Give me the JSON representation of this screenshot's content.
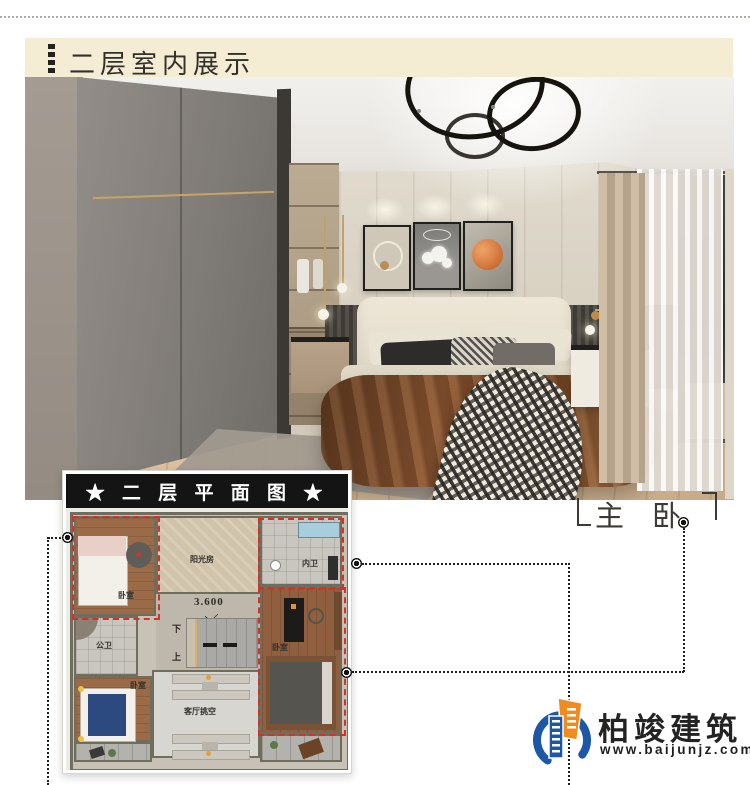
{
  "header": {
    "title": "二层室内展示"
  },
  "plan": {
    "title": "★ 二 层 平 面 图 ★",
    "labels": {
      "sunroom": "阳光房",
      "inner_bath": "内卫",
      "bedroom_top_left": "卧室",
      "public_bath": "公卫",
      "bedroom_right": "卧室",
      "bedroom_bottom_left": "卧室",
      "living_void": "客厅挑空",
      "dimension": "3.600",
      "stair_down": "下",
      "stair_up": "上"
    }
  },
  "callout": {
    "master_bedroom": "主 卧"
  },
  "logo": {
    "company": "柏竣建筑",
    "website": "www.baijunjz.com"
  },
  "colors": {
    "header_bg": "#f5ecd4",
    "plan_titlebar_bg": "#141414",
    "highlight_red": "#d43226",
    "logo_blue": "#1d57a5",
    "logo_orange": "#f08c1e"
  }
}
